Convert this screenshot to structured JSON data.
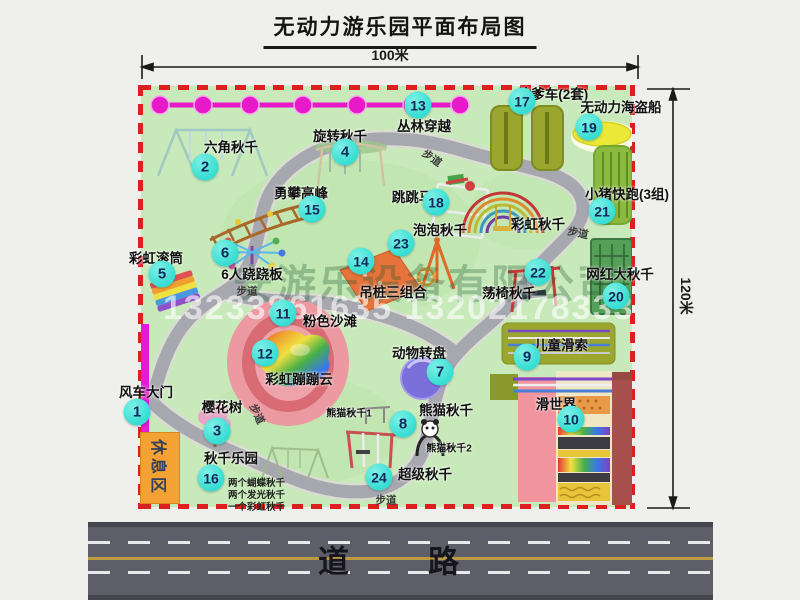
{
  "title": "无动力游乐园平面布局图",
  "dims": {
    "width_label": "100米",
    "height_label": "120米"
  },
  "road": {
    "label": "道　路"
  },
  "watermark": {
    "company": "安游乐设备有限公司",
    "phone": "13233861635 13202178333"
  },
  "walkway_label": "步道",
  "rest_area_label": "休息区",
  "extra_labels": {
    "rainbow_swing": "彩虹秋千",
    "panda_swing_1": "熊猫秋千1",
    "panda_swing_2": "熊猫秋千2",
    "swing_park_note_1": "两个蝴蝶秋千",
    "swing_park_note_2": "两个发光秋千",
    "swing_park_note_3": "一个彩虹秋千"
  },
  "pois": [
    {
      "num": "1",
      "label": "风车大门"
    },
    {
      "num": "2",
      "label": "六角秋千"
    },
    {
      "num": "3",
      "label": "樱花树"
    },
    {
      "num": "4",
      "label": "旋转秋千"
    },
    {
      "num": "5",
      "label": "彩虹滚筒"
    },
    {
      "num": "6",
      "label": "6人跷跷板"
    },
    {
      "num": "7",
      "label": "动物转盘"
    },
    {
      "num": "8",
      "label": "熊猫秋千"
    },
    {
      "num": "9",
      "label": "儿童滑索"
    },
    {
      "num": "10",
      "label": "滑世界"
    },
    {
      "num": "11",
      "label": "粉色沙滩"
    },
    {
      "num": "12",
      "label": "彩虹蹦蹦云"
    },
    {
      "num": "13",
      "label": "丛林穿越"
    },
    {
      "num": "14",
      "label": "吊桩三组合"
    },
    {
      "num": "15",
      "label": "勇攀高峰"
    },
    {
      "num": "16",
      "label": "秋千乐园"
    },
    {
      "num": "17",
      "label": "坑爹车(2套)"
    },
    {
      "num": "18",
      "label": "跳跳马"
    },
    {
      "num": "19",
      "label": "无动力海盗船"
    },
    {
      "num": "20",
      "label": "网红大秋千"
    },
    {
      "num": "21",
      "label": "小猪快跑(3组)"
    },
    {
      "num": "22",
      "label": "荡椅秋千"
    },
    {
      "num": "23",
      "label": "泡泡秋千"
    },
    {
      "num": "24",
      "label": "超级秋千"
    }
  ]
}
